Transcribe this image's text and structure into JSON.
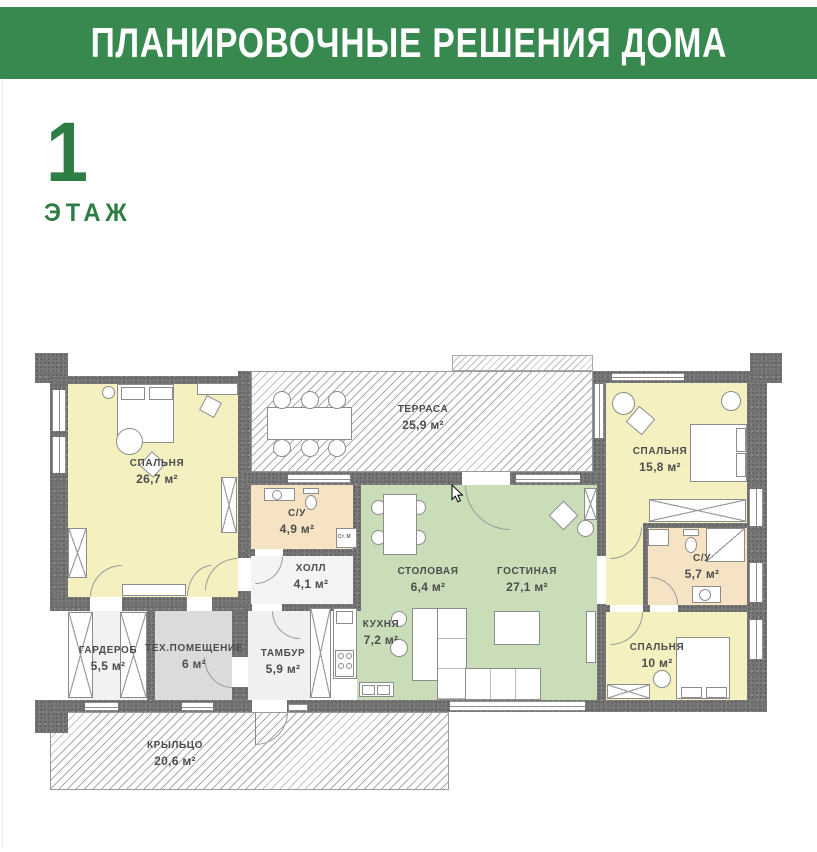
{
  "header": {
    "title": "ПЛАНИРОВОЧНЫЕ РЕШЕНИЯ ДОМА"
  },
  "floor": {
    "number": "1",
    "label": "ЭТАЖ"
  },
  "rooms": {
    "bedroom1": {
      "name": "СПАЛЬНЯ",
      "area": "26,7 м²"
    },
    "terrace": {
      "name": "ТЕРРАСА",
      "area": "25,9 м²"
    },
    "bedroom2": {
      "name": "СПАЛЬНЯ",
      "area": "15,8 м²"
    },
    "bath2": {
      "name": "С/У",
      "area": "5,7 м²"
    },
    "bedroom3": {
      "name": "СПАЛЬНЯ",
      "area": "10 м²"
    },
    "bath1": {
      "name": "С/У",
      "area": "4,9 м²"
    },
    "hall": {
      "name": "ХОЛЛ",
      "area": "4,1 м²"
    },
    "dining": {
      "name": "СТОЛОВАЯ",
      "area": "6,4 м²"
    },
    "living": {
      "name": "ГОСТИНАЯ",
      "area": "27,1 м²"
    },
    "kitchen": {
      "name": "КУХНЯ",
      "area": "7,2 м²"
    },
    "wardrobe": {
      "name": "ГАРДЕРОБ",
      "area": "5,5 м²"
    },
    "tech": {
      "name": "ТЕХ.ПОМЕЩЕНИЕ",
      "area": "6 м²"
    },
    "tambour": {
      "name": "ТАМБУР",
      "area": "5,9 м²"
    },
    "porch": {
      "name": "КРЫЛЬЦО",
      "area": "20,6 м²"
    }
  },
  "annotations": {
    "washer": "Ст. М"
  },
  "colors": {
    "banner_green": "#38894f",
    "accent_green": "#2e7d45",
    "room_yellow": "#f4f0bf",
    "room_green": "#c9ddb8",
    "room_beige": "#f6e3c4",
    "tech_gray": "#dbdbdb",
    "wall_gray": "#757575"
  }
}
